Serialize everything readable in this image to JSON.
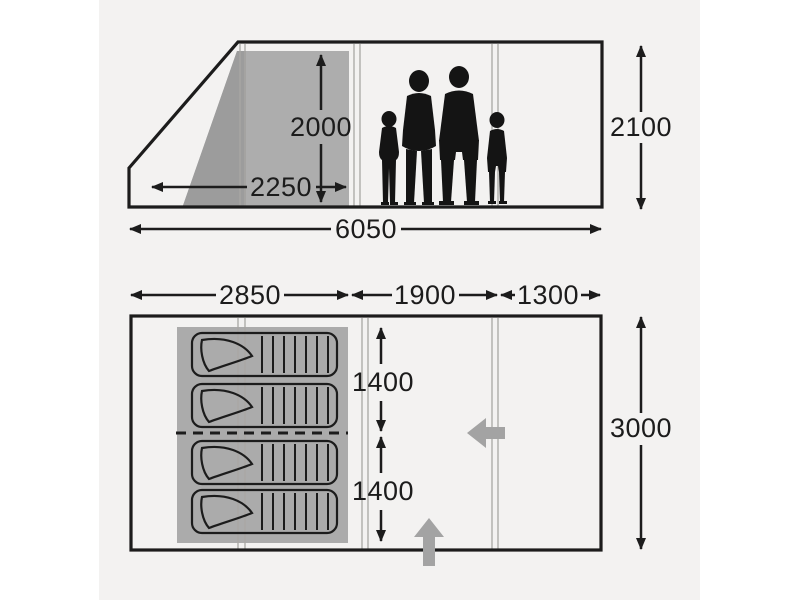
{
  "page": {
    "background": "#ffffff",
    "canvas_background": "#f3f2f1",
    "line_color": "#1c1c1c",
    "bedroom_gray": "#ababab",
    "elevation_gray": "#adadad",
    "elevation_gray_dark": "#9c9c9c",
    "entrance_arrow_color": "#a3a3a3",
    "silhouette_color": "#141414"
  },
  "side_view": {
    "description": "Tent side elevation with family silhouette for scale",
    "dims": {
      "inner_height": {
        "label": "2000"
      },
      "bedroom_width": {
        "label": "2250"
      },
      "total_length": {
        "label": "6050"
      },
      "outer_height": {
        "label": "2100"
      }
    }
  },
  "floor_plan": {
    "description": "Tent floor plan with sleeping cabin, living area and canopy section",
    "dims": {
      "bedroom_length": {
        "label": "2850"
      },
      "living_length": {
        "label": "1900"
      },
      "canopy_length": {
        "label": "1300"
      },
      "bedroom_depth_upper": {
        "label": "1400"
      },
      "bedroom_depth_lower": {
        "label": "1400"
      },
      "total_width": {
        "label": "3000"
      }
    },
    "sleeping_bag_count": 4,
    "entrances": [
      "front-entrance-up-arrow",
      "side-entrance-left-arrow"
    ]
  }
}
